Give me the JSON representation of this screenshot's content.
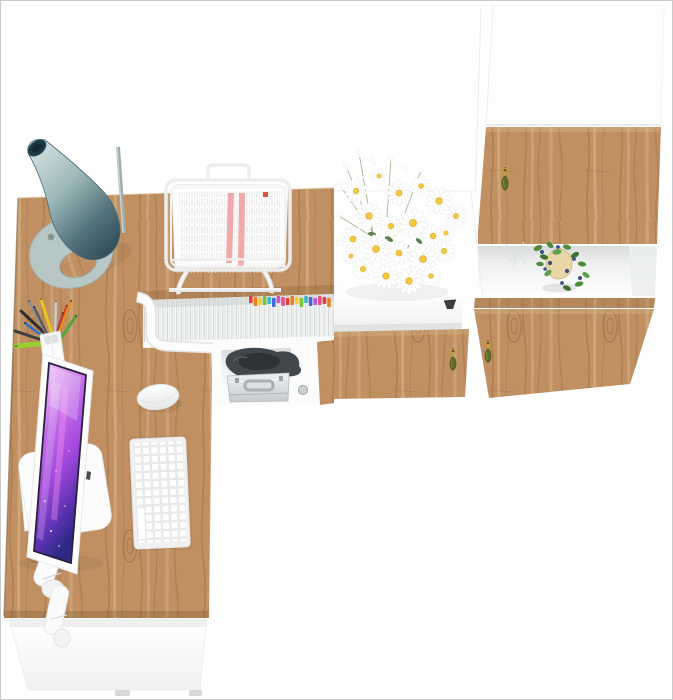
{
  "image": {
    "width": 673,
    "height": 700,
    "background": "#ffffff",
    "frame_border": "#c9c9c9",
    "description": "Top-down 3D render of an L-shaped oak and white home-office furniture set"
  },
  "colors": {
    "wood_base": "#c09062",
    "wood_grain": "#8e6136",
    "wood_light": "#dcbd90",
    "wood_edge_shadow": "#7a5530",
    "panel_white": "#fbfbfb",
    "panel_line": "#e7e7e7",
    "lamp_light": "#dfe9e8",
    "lamp_mid": "#9db8ba",
    "lamp_dark": "#37525d",
    "lamp_base": "#b7c7c6",
    "screen_top": "#f0d9fb",
    "screen_purple": "#a449dd",
    "screen_navy": "#2c2a84",
    "screen_pink": "#ff9cf5",
    "key_brass": "#c0a03c",
    "tassel_olive": "#5f6d26",
    "plant_green": "#4c8c3c",
    "berry_blue": "#3c4f85",
    "pot_beige": "#e9d6a6",
    "red_stripe": "#efa0a0",
    "red_mark": "#e0523e",
    "case_silver_light": "#eef0f1",
    "case_silver_dark": "#c6cbcf",
    "dark_item": "#41474b"
  },
  "book_tab_colors": [
    "#e04438",
    "#f07d1f",
    "#f2cf2a",
    "#7cc43a",
    "#3bb6cf",
    "#4468d8",
    "#c455cc",
    "#e8508a"
  ],
  "pen_colors": [
    "#2e2e2e",
    "#8a8f94",
    "#e8c522",
    "#c7cdd2",
    "#d43d2a",
    "#58a636",
    "#3b3f43",
    "#9acd32",
    "#2e6fc4",
    "#e78a1e",
    "#555a5f",
    "#b0413e"
  ],
  "objects": {
    "desk": {
      "label": "oak corner desk"
    },
    "front_panel": {
      "label": "white desk front panel"
    },
    "lamp": {
      "label": "teal cone desk lamp"
    },
    "document_tray": {
      "label": "white wire document stand with papers"
    },
    "pencil_cup": {
      "label": "white pencil cup with pens"
    },
    "monitor": {
      "label": "white monitor with purple wallpaper"
    },
    "keyboard": {
      "label": "white compact keyboard"
    },
    "mouse": {
      "label": "white mouse"
    },
    "hutch": {
      "label": "under-desk shelf with binders and metal case"
    },
    "sideboard": {
      "label": "white sideboard with oak drawer and key"
    },
    "tall_cabinet": {
      "label": "tall white cabinet with oak doors, keys and plant"
    },
    "flowers": {
      "label": "white daisy bouquet"
    },
    "plant": {
      "label": "green plant with blue berries in pot"
    }
  }
}
